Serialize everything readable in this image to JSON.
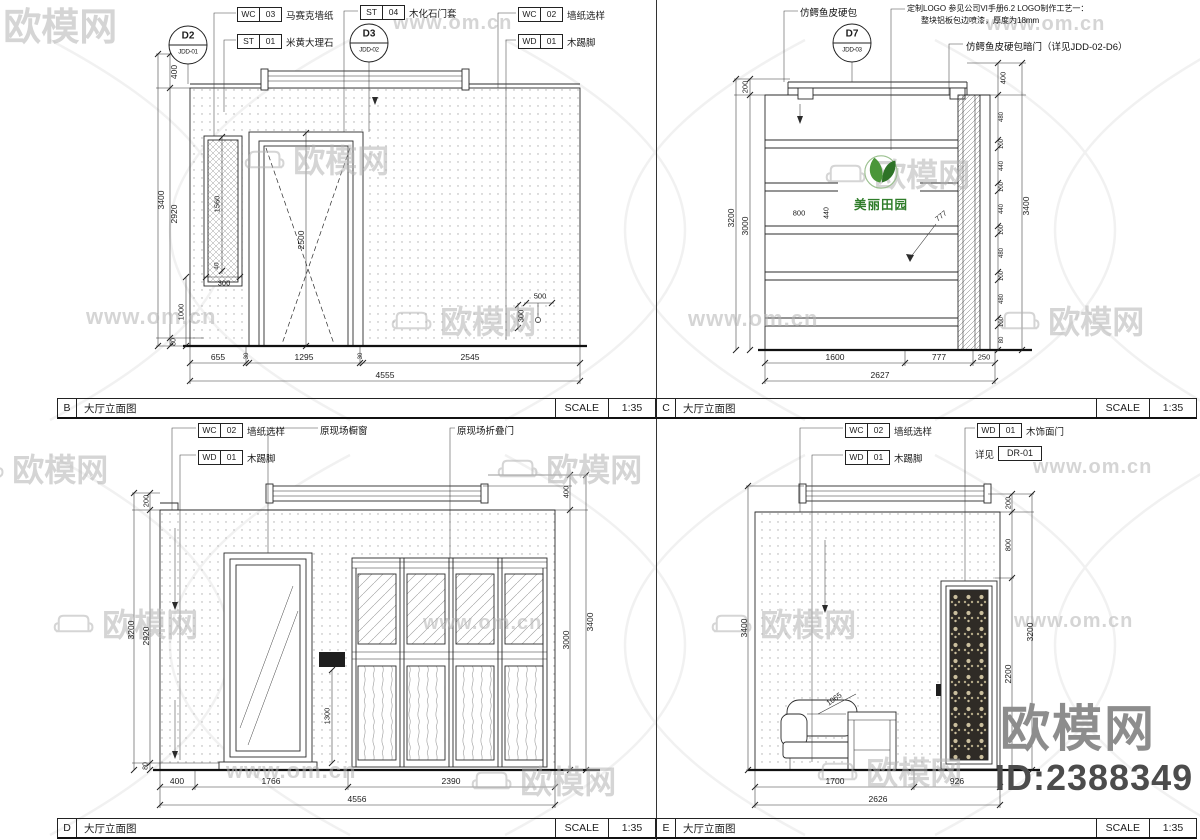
{
  "panels": {
    "B": {
      "label": "B",
      "title": "大厅立面图",
      "scale_label": "SCALE",
      "scale_value": "1:35"
    },
    "C": {
      "label": "C",
      "title": "大厅立面图",
      "scale_label": "SCALE",
      "scale_value": "1:35"
    },
    "D": {
      "label": "D",
      "title": "大厅立面图",
      "scale_label": "SCALE",
      "scale_value": "1:35"
    },
    "E": {
      "label": "E",
      "title": "大厅立面图",
      "scale_label": "SCALE",
      "scale_value": "1:35"
    }
  },
  "logo": {
    "name": "美丽田园"
  },
  "footer": {
    "brand": "欧模网",
    "id": "ID:2388349"
  },
  "watermark": {
    "site": "www.om.cn",
    "brand": "欧模网"
  },
  "callouts": [
    {
      "c": "WC",
      "n": "03",
      "t": "马赛克墙纸",
      "x": 237,
      "y": 7
    },
    {
      "c": "ST",
      "n": "01",
      "t": "米黄大理石",
      "x": 237,
      "y": 34
    },
    {
      "c": "ST",
      "n": "04",
      "t": "木化石门套",
      "x": 360,
      "y": 5
    },
    {
      "c": "WC",
      "n": "02",
      "t": "墙纸选样",
      "x": 518,
      "y": 7
    },
    {
      "c": "WD",
      "n": "01",
      "t": "木踢脚",
      "x": 518,
      "y": 34
    },
    {
      "c": "WC",
      "n": "02",
      "t": "墙纸选样",
      "x": 198,
      "y": 423
    },
    {
      "c": "WD",
      "n": "01",
      "t": "木踢脚",
      "x": 198,
      "y": 450
    },
    {
      "c": "WC",
      "n": "02",
      "t": "墙纸选样",
      "x": 845,
      "y": 423
    },
    {
      "c": "WD",
      "n": "01",
      "t": "木踢脚",
      "x": 845,
      "y": 450
    },
    {
      "c": "WD",
      "n": "01",
      "t": "木饰面门",
      "x": 977,
      "y": 423
    }
  ],
  "refs": [
    {
      "p": "详见",
      "v": "DR-01",
      "x": 975,
      "y": 446
    }
  ],
  "bubbles": [
    {
      "top": "D2",
      "bottom": "JDD-01",
      "x": 188,
      "y": 45
    },
    {
      "top": "D3",
      "bottom": "JDD-02",
      "x": 369,
      "y": 43
    },
    {
      "top": "D7",
      "bottom": "JDD-03",
      "x": 852,
      "y": 43
    }
  ],
  "notes": [
    {
      "t": "仿鳄鱼皮硬包",
      "x": 800,
      "y": 5
    },
    {
      "t": "定制LOGO 参见公司VI手册6.2 LOGO制作工艺一：",
      "x": 907,
      "y": 3,
      "s": 8
    },
    {
      "t": "整块铝板包边喷漆，厚度为18mm",
      "x": 921,
      "y": 15,
      "s": 8
    },
    {
      "t": "仿鳄鱼皮硬包暗门（详见JDD-02-D6）",
      "x": 966,
      "y": 39,
      "s": 9.5
    },
    {
      "t": "原现场橱窗",
      "x": 320,
      "y": 423
    },
    {
      "t": "原现场折叠门",
      "x": 457,
      "y": 423
    }
  ],
  "labels": [
    {
      "t": "400",
      "x": 174,
      "y": 72,
      "r": -90
    },
    {
      "t": "2920",
      "x": 174,
      "y": 214,
      "r": -90
    },
    {
      "t": "80",
      "x": 174,
      "y": 342,
      "r": -90,
      "s": 7
    },
    {
      "t": "3400",
      "x": 161,
      "y": 200,
      "r": -90
    },
    {
      "t": "1560",
      "x": 217,
      "y": 204,
      "r": -90,
      "s": 7.5
    },
    {
      "t": "40",
      "x": 217,
      "y": 266,
      "r": -90,
      "s": 6.5
    },
    {
      "t": "300",
      "x": 224,
      "y": 283,
      "s": 7.5
    },
    {
      "t": "1000",
      "x": 181,
      "y": 312,
      "r": -90,
      "s": 7.5
    },
    {
      "t": "2500",
      "x": 301,
      "y": 240,
      "r": -90
    },
    {
      "t": "500",
      "x": 540,
      "y": 296,
      "s": 7.5
    },
    {
      "t": "300",
      "x": 521,
      "y": 316,
      "r": -90,
      "s": 7.5
    },
    {
      "t": "655",
      "x": 218,
      "y": 357
    },
    {
      "t": "30",
      "x": 247,
      "y": 356,
      "r": -90,
      "s": 6
    },
    {
      "t": "1295",
      "x": 304,
      "y": 357
    },
    {
      "t": "30",
      "x": 361,
      "y": 356,
      "r": -90,
      "s": 6
    },
    {
      "t": "2545",
      "x": 470,
      "y": 357
    },
    {
      "t": "4555",
      "x": 385,
      "y": 375
    },
    {
      "t": "200",
      "x": 745,
      "y": 87,
      "r": -90,
      "s": 7.5
    },
    {
      "t": "3000",
      "x": 745,
      "y": 226,
      "r": -90
    },
    {
      "t": "3200",
      "x": 731,
      "y": 218,
      "r": -90
    },
    {
      "t": "400",
      "x": 1003,
      "y": 78,
      "r": -90,
      "s": 7.5
    },
    {
      "t": "480",
      "x": 1002,
      "y": 117,
      "r": -90,
      "s": 6
    },
    {
      "t": "100",
      "x": 1002,
      "y": 144,
      "r": -90,
      "s": 6
    },
    {
      "t": "440",
      "x": 1002,
      "y": 166,
      "r": -90,
      "s": 6
    },
    {
      "t": "100",
      "x": 1002,
      "y": 187,
      "r": -90,
      "s": 6
    },
    {
      "t": "440",
      "x": 1002,
      "y": 209,
      "r": -90,
      "s": 6
    },
    {
      "t": "100",
      "x": 1002,
      "y": 230,
      "r": -90,
      "s": 6
    },
    {
      "t": "480",
      "x": 1002,
      "y": 253,
      "r": -90,
      "s": 6
    },
    {
      "t": "100",
      "x": 1002,
      "y": 276,
      "r": -90,
      "s": 6
    },
    {
      "t": "480",
      "x": 1002,
      "y": 299,
      "r": -90,
      "s": 6
    },
    {
      "t": "100",
      "x": 1002,
      "y": 322,
      "r": -90,
      "s": 6
    },
    {
      "t": "80",
      "x": 1002,
      "y": 340,
      "r": -90,
      "s": 6
    },
    {
      "t": "3400",
      "x": 1026,
      "y": 206,
      "r": -90
    },
    {
      "t": "800",
      "x": 799,
      "y": 213,
      "s": 7.5
    },
    {
      "t": "440",
      "x": 827,
      "y": 213,
      "r": -90,
      "s": 7
    },
    {
      "t": "777",
      "x": 941,
      "y": 216,
      "r": -38,
      "s": 7.5
    },
    {
      "t": "1600",
      "x": 835,
      "y": 357
    },
    {
      "t": "777",
      "x": 939,
      "y": 357
    },
    {
      "t": "250",
      "x": 984,
      "y": 357,
      "s": 7.5
    },
    {
      "t": "2627",
      "x": 880,
      "y": 375
    },
    {
      "t": "200",
      "x": 146,
      "y": 501,
      "r": -90,
      "s": 7.5
    },
    {
      "t": "2920",
      "x": 146,
      "y": 636,
      "r": -90
    },
    {
      "t": "80",
      "x": 146,
      "y": 766,
      "r": -90,
      "s": 7
    },
    {
      "t": "3200",
      "x": 131,
      "y": 630,
      "r": -90
    },
    {
      "t": "400",
      "x": 566,
      "y": 492,
      "r": -90,
      "s": 7.5
    },
    {
      "t": "3000",
      "x": 566,
      "y": 640,
      "r": -90
    },
    {
      "t": "3400",
      "x": 590,
      "y": 622,
      "r": -90
    },
    {
      "t": "1300",
      "x": 327,
      "y": 716,
      "r": -90,
      "s": 7.5
    },
    {
      "t": "400",
      "x": 177,
      "y": 781
    },
    {
      "t": "1766",
      "x": 271,
      "y": 781
    },
    {
      "t": "2390",
      "x": 451,
      "y": 781
    },
    {
      "t": "4556",
      "x": 357,
      "y": 799
    },
    {
      "t": "3400",
      "x": 744,
      "y": 628,
      "r": -90
    },
    {
      "t": "200",
      "x": 1008,
      "y": 503,
      "r": -90,
      "s": 7.5
    },
    {
      "t": "800",
      "x": 1008,
      "y": 545,
      "r": -90,
      "s": 7.5
    },
    {
      "t": "2200",
      "x": 1008,
      "y": 674,
      "r": -90
    },
    {
      "t": "3200",
      "x": 1030,
      "y": 632,
      "r": -90
    },
    {
      "t": "1065",
      "x": 834,
      "y": 699,
      "r": -35,
      "s": 7.5
    },
    {
      "t": "1700",
      "x": 835,
      "y": 781
    },
    {
      "t": "926",
      "x": 957,
      "y": 781
    },
    {
      "t": "2626",
      "x": 878,
      "y": 799
    }
  ],
  "watermarks": [
    {
      "b": 1,
      "x": -55,
      "y": -4,
      "s": 38
    },
    {
      "x": 393,
      "y": 12,
      "s": 20
    },
    {
      "x": 986,
      "y": 13,
      "s": 20
    },
    {
      "b": 1,
      "x": 243,
      "y": 136,
      "s": 32
    },
    {
      "b": 1,
      "x": 824,
      "y": 150,
      "s": 32
    },
    {
      "x": 86,
      "y": 304,
      "s": 22
    },
    {
      "b": 1,
      "x": 390,
      "y": 297,
      "s": 32
    },
    {
      "x": 688,
      "y": 306,
      "s": 22
    },
    {
      "b": 1,
      "x": 998,
      "y": 297,
      "s": 32
    },
    {
      "b": 1,
      "x": -38,
      "y": 445,
      "s": 32
    },
    {
      "b": 1,
      "x": 496,
      "y": 445,
      "s": 32
    },
    {
      "x": 1033,
      "y": 456,
      "s": 20
    },
    {
      "b": 1,
      "x": 52,
      "y": 600,
      "s": 32
    },
    {
      "x": 423,
      "y": 612,
      "s": 20
    },
    {
      "b": 1,
      "x": 710,
      "y": 600,
      "s": 32
    },
    {
      "x": 1014,
      "y": 610,
      "s": 20
    },
    {
      "x": 226,
      "y": 758,
      "s": 22
    },
    {
      "b": 1,
      "x": 470,
      "y": 757,
      "s": 32
    },
    {
      "b": 1,
      "x": 816,
      "y": 748,
      "s": 32
    }
  ]
}
